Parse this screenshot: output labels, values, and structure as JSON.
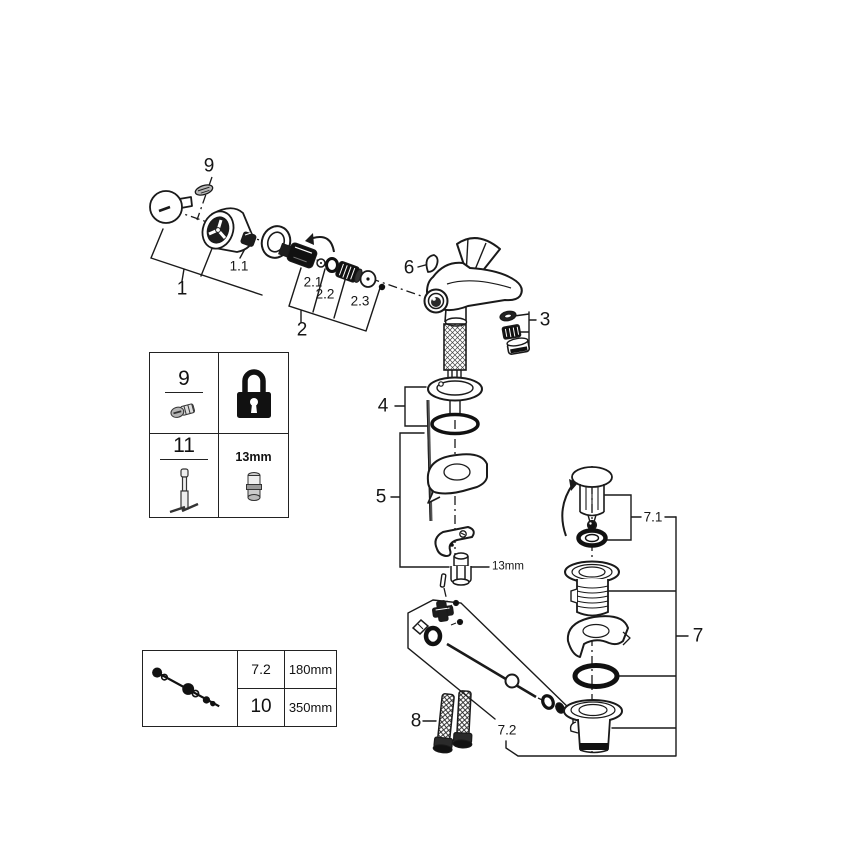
{
  "palette": {
    "line": "#1a1a1a",
    "background": "#ffffff",
    "solid": "#111111"
  },
  "callouts": {
    "c9": "9",
    "c1": "1",
    "c1_1": "1.1",
    "c2": "2",
    "c2_1": "2.1",
    "c2_2": "2.2",
    "c2_3": "2.3",
    "c6": "6",
    "c3": "3",
    "c4": "4",
    "c5": "5",
    "nut_size": "13mm",
    "c7_1": "7.1",
    "c7": "7",
    "c8": "8",
    "c7_2": "7.2"
  },
  "tool_table": {
    "rows": [
      {
        "ref": "9",
        "part_icon": "grub-screw-icon",
        "tool_icon": "padlock-icon"
      },
      {
        "ref": "11",
        "part_icon": "mounting-pin-tool-icon",
        "tool_icon": "socket-icon",
        "tool_size": "13mm"
      }
    ]
  },
  "size_table": {
    "icon": "pop-up-rod-icon",
    "rows": [
      {
        "ref": "7.2",
        "length": "180mm"
      },
      {
        "ref": "10",
        "length": "350mm"
      }
    ]
  }
}
